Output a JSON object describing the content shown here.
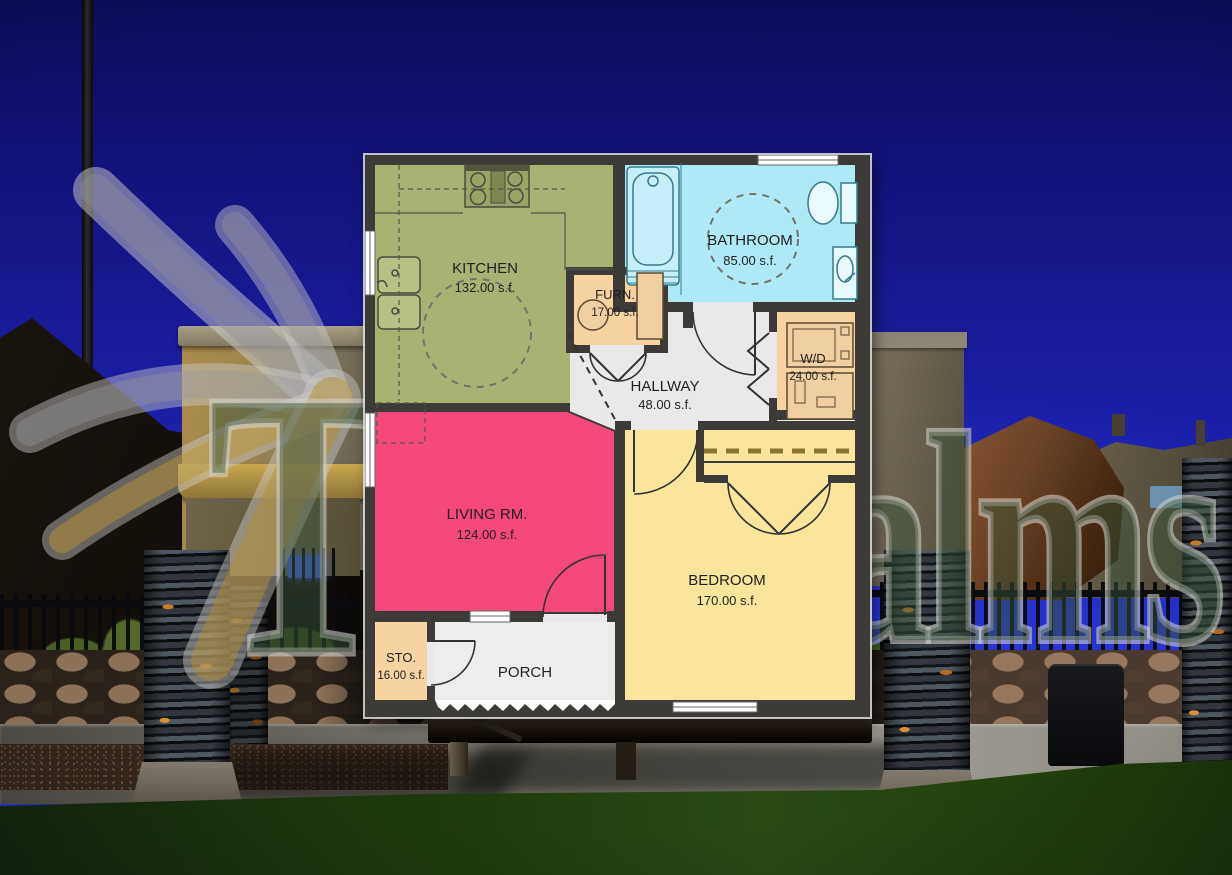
{
  "watermark": {
    "word1": "The",
    "word2": "Palms"
  },
  "floor_plan": {
    "wall_color": "#3d3b38",
    "rooms": {
      "kitchen": {
        "label": "KITCHEN",
        "area": "132.00 s.f.",
        "color": "#a9b173"
      },
      "bathroom": {
        "label": "BATHROOM",
        "area": "85.00 s.f.",
        "color": "#aeeaf6"
      },
      "furnace": {
        "label": "FURN.",
        "area": "17.00 s.f.",
        "color": "#f8d3a2"
      },
      "washer_dryer": {
        "label": "W/D",
        "area": "24.00 s.f.",
        "color": "#f8d3a2"
      },
      "hallway": {
        "label": "HALLWAY",
        "area": "48.00 s.f.",
        "color": "#e9e9e9"
      },
      "living": {
        "label": "LIVING RM.",
        "area": "124.00 s.f.",
        "color": "#f5497c"
      },
      "bedroom": {
        "label": "BEDROOM",
        "area": "170.00 s.f.",
        "color": "#f9e59b"
      },
      "storage": {
        "label": "STO.",
        "area": "16.00 s.f.",
        "color": "#f8d3a2"
      },
      "porch": {
        "label": "PORCH",
        "color": "#ededed"
      }
    }
  }
}
